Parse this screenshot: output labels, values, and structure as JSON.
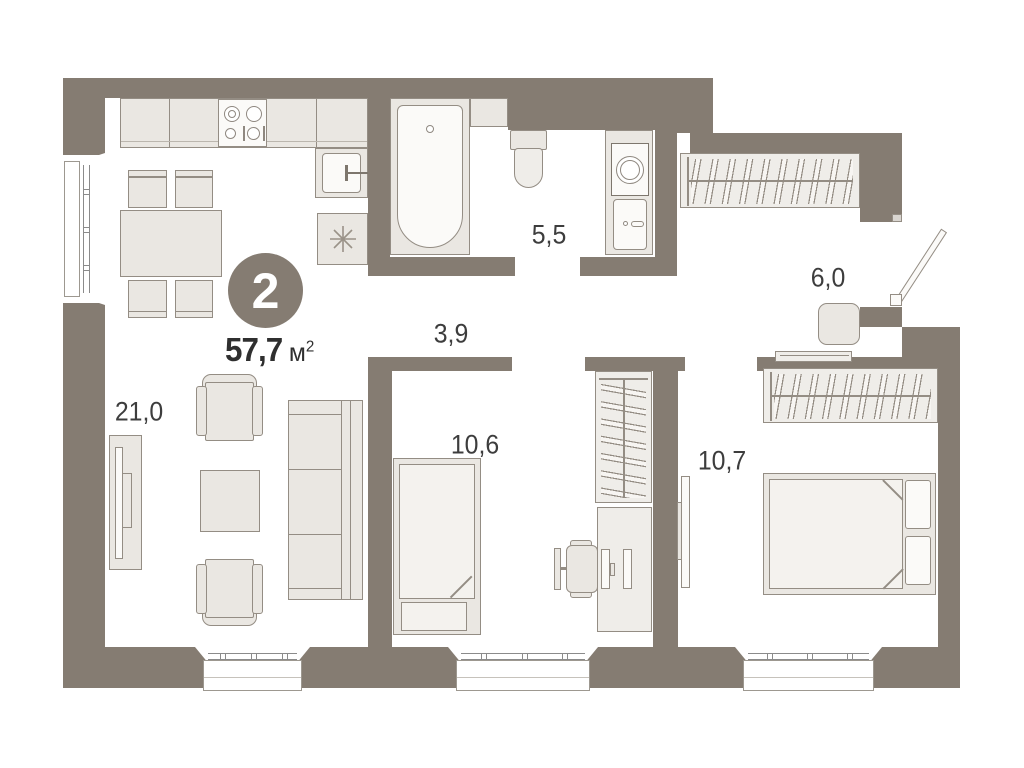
{
  "plan": {
    "badge": {
      "rooms_count": "2"
    },
    "total_area": {
      "value": "57,7",
      "unit_base": "м",
      "unit_sup": "2"
    },
    "rooms": {
      "living_kitchen": {
        "label": "21,0"
      },
      "bathroom": {
        "label": "5,5"
      },
      "hall": {
        "label": "3,9"
      },
      "entry": {
        "label": "6,0"
      },
      "bedroom_small": {
        "label": "10,6"
      },
      "bedroom_master": {
        "label": "10,7"
      }
    },
    "colors": {
      "wall": "#857C72",
      "furniture_fill": "#EAE7E2",
      "furniture_fill_light": "#F4F2EE",
      "stroke": "#948D84",
      "text": "#3D3D3D",
      "floor": "#FFFFFF"
    }
  }
}
